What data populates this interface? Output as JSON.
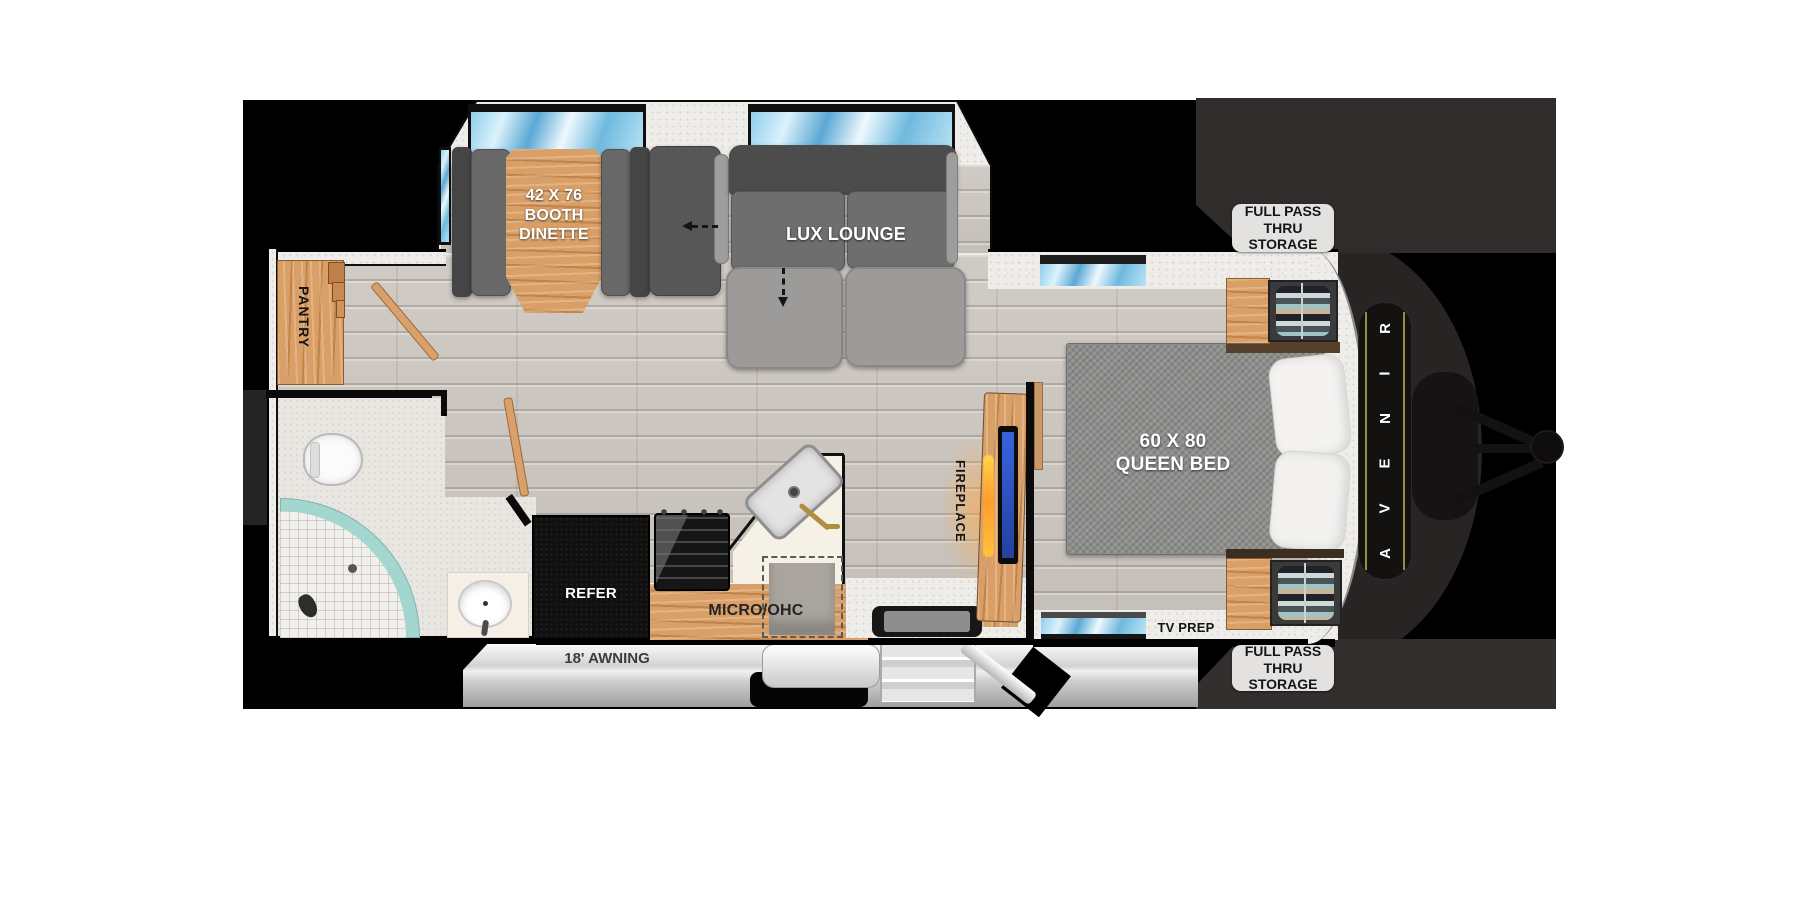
{
  "floorplan": {
    "brand": {
      "name": "AVENIR",
      "letters_top_to_bottom": [
        "R",
        "I",
        "N",
        "E",
        "V",
        "A"
      ],
      "accent_gold": "#9a8a4a"
    },
    "labels": {
      "dinette": {
        "line1": "42 X 76",
        "line2": "BOOTH",
        "line3": "DINETTE"
      },
      "lounge": "LUX LOUNGE",
      "pantry": "PANTRY",
      "bed": {
        "line1": "60 X 80",
        "line2": "QUEEN BED"
      },
      "fireplace": "FIREPLACE",
      "refer": "REFER",
      "micro_ohc": "MICRO/OHC",
      "tv_prep": "TV PREP",
      "storage_front_top": {
        "line1": "FULL PASS THRU",
        "line2": "STORAGE"
      },
      "storage_front_bottom": {
        "line1": "FULL PASS THRU",
        "line2": "STORAGE"
      },
      "awning": "18' AWNING"
    },
    "colors": {
      "background": "#000000",
      "floor_plank": "#cbc5bf",
      "wall_speckle": "#efedea",
      "window_blue": "#6fb9dd",
      "cabinet_wood": "#d99f66",
      "sofa_gray": "#6a6a6a",
      "bed_gray": "#8e8e8d",
      "shower_teal": "#a3d6cf",
      "counter_cream": "#f6f1e7",
      "front_storage_gray": "#312d2d",
      "label_bg": "#e3e2e1",
      "tv_screen_blue": "#2f55cc",
      "fireplace_glow": "#ff9d2e"
    }
  }
}
